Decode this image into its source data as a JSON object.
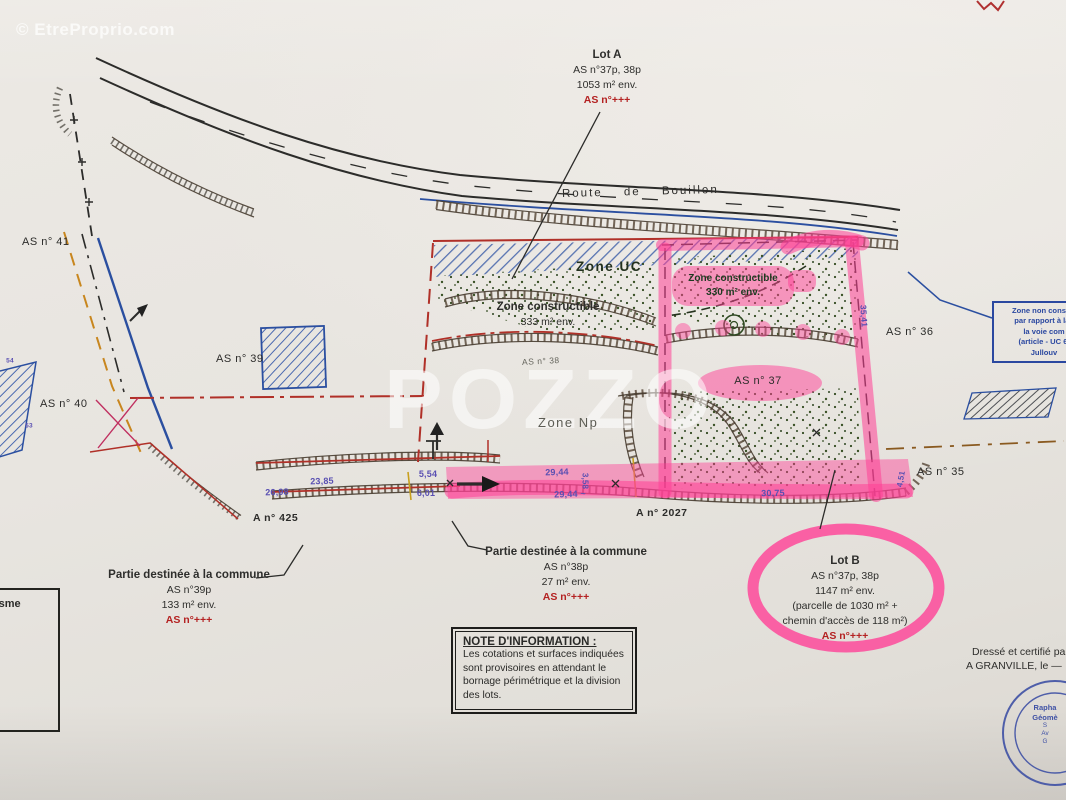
{
  "watermarks": {
    "photo_credit": "© EtreProprio.com",
    "brand": "POZZO"
  },
  "labels": {
    "road": "Route de Bouillon",
    "zone_uc": "Zone UC",
    "zone_np": "Zone Np"
  },
  "lot_a": {
    "title": "Lot A",
    "ref": "AS n°37p, 38p",
    "area": "1053 m² env.",
    "red": "AS n°+++"
  },
  "lot_b": {
    "title": "Lot B",
    "ref": "AS n°37p, 38p",
    "area": "1147 m² env.",
    "detail1": "(parcelle de 1030 m² +",
    "detail2": "chemin d'accès de 118 m²)",
    "red": "AS n°+++"
  },
  "commune_left": {
    "title": "Partie destinée à la commune",
    "ref": "AS n°39p",
    "area": "133 m² env.",
    "red": "AS n°+++"
  },
  "commune_center": {
    "title": "Partie destinée à la commune",
    "ref": "AS n°38p",
    "area": "27 m² env.",
    "red": "AS n°+++"
  },
  "constructible_uc": {
    "line1": "Zone constructible",
    "line2": "330 m² env."
  },
  "constructible_main": {
    "line1": "Zone constructible",
    "line2": "333 m² env."
  },
  "parcels": {
    "as41": "AS n° 41",
    "as40": "AS n° 40",
    "as39": "AS n° 39",
    "as38": "AS n° 38",
    "as37": "AS n° 37",
    "as36": "AS n° 36",
    "as35": "AS n° 35"
  },
  "cadastre": {
    "a425": "A n° 425",
    "a2027": "A n° 2027"
  },
  "measurements": {
    "m1": "23,85",
    "m2": "26,98",
    "m3": "5,54",
    "m4": "6,01",
    "m5": "29,44",
    "m6": "29,44 ~",
    "m7": "30,75",
    "m8": "35,41",
    "m9": "4,51",
    "m10": "3,58",
    "m11": "54",
    "m12": "53"
  },
  "note_box": {
    "title": "NOTE D'INFORMATION :",
    "line1": "Les cotations et surfaces indiquées",
    "line2": "sont provisoires en attendant le",
    "line3": "bornage périmétrique et la division",
    "line4": "des lots."
  },
  "blue_note": {
    "line1": "Zone non constru",
    "line2": "par rapport à la l",
    "line3": "la voie com",
    "line4": "(article - UC 6.",
    "line5": "Jullouv"
  },
  "left_box": {
    "label": "banisme"
  },
  "certification": {
    "line1": "Dressé et certifié par",
    "line2": "A GRANVILLE, le —",
    "stamp1": "Rapha",
    "stamp2": "Géomè",
    "stamp3": "S",
    "stamp4": "Av",
    "stamp5": "G"
  },
  "colors": {
    "highlighter_pink": "#ff40a0",
    "ink_red": "#b03028",
    "ink_blue": "#2b4fa0",
    "measure_blue": "#5a50b2",
    "stamp_blue": "#3f51a5"
  }
}
